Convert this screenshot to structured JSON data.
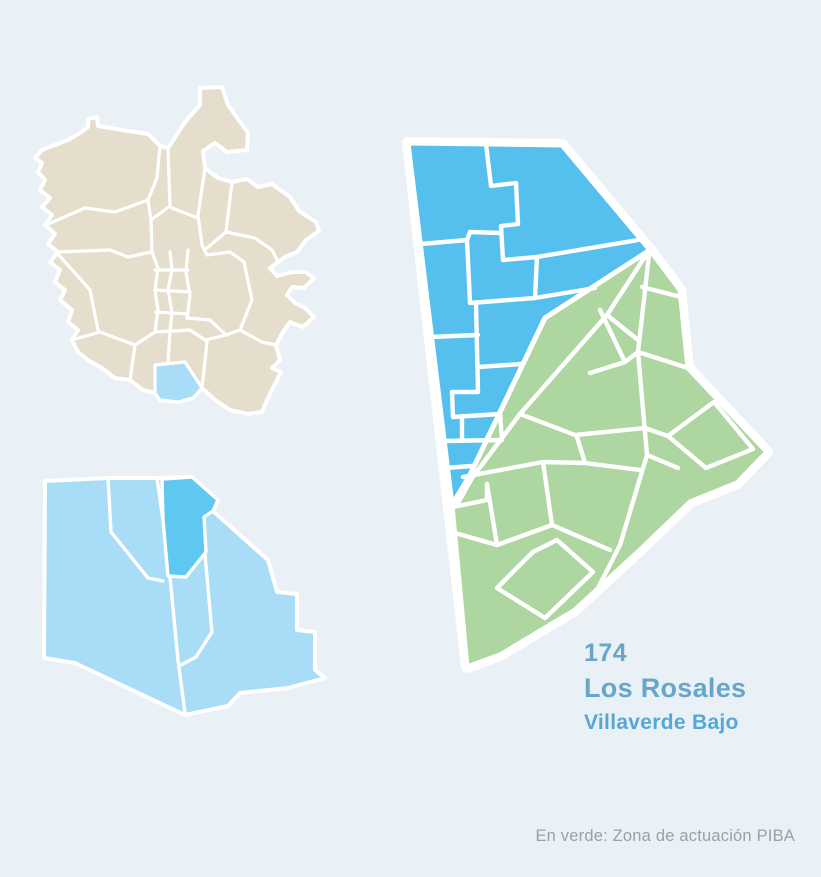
{
  "labels": {
    "area_code": "174",
    "area_name": "Los Rosales",
    "district_name": "Villaverde Bajo",
    "legend_note": "En verde: Zona de actuación PIBA"
  },
  "colors": {
    "background": "#e9f1f6",
    "madridFill": "#e5decd",
    "highlightLight": "#a9dcf6",
    "highlightDark": "#5ec8f0",
    "mainBlue": "#55c0ed",
    "pibaGreen": "#aed6a1",
    "titleBlue": "#68a6c9",
    "subtitleBlue": "#55a7d6",
    "noteGray": "#99a1a8"
  }
}
